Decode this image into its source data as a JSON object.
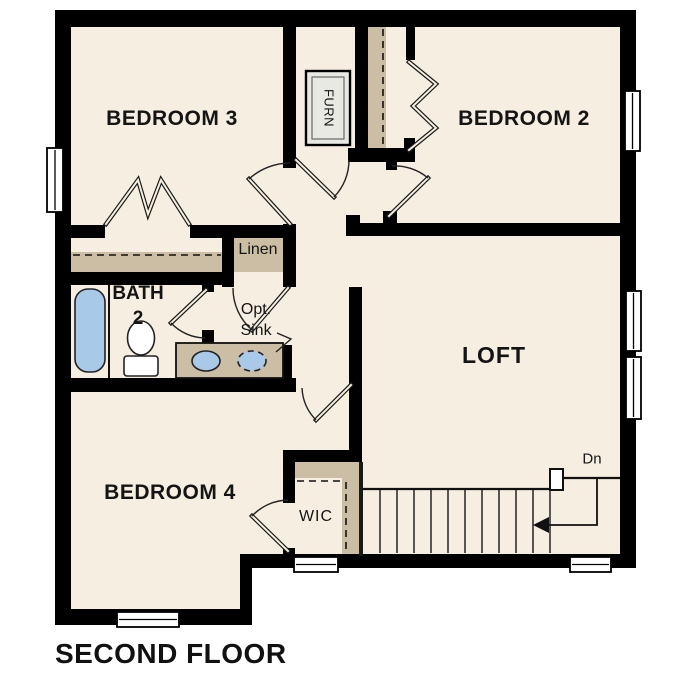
{
  "title": "SECOND FLOOR",
  "rooms": {
    "bedroom3": "BEDROOM 3",
    "bedroom2": "BEDROOM 2",
    "loft": "LOFT",
    "bedroom4": "BEDROOM 4",
    "bath": {
      "line1": "BATH",
      "line2": "2"
    }
  },
  "closets": {
    "linen": "Linen",
    "wic": "WIC"
  },
  "labels": {
    "furnace": "FURN",
    "optional_sink": {
      "line1": "Opt.",
      "line2": "Sink"
    },
    "stairs_down": "Dn"
  },
  "colors": {
    "floor": "#F6EFE1",
    "wall": "#000000",
    "shelf_tan": "#CBBEA4",
    "fixture_blue": "#A9C9E8",
    "furnace_gray": "#E9E9E4",
    "window_white": "#FFFFFF"
  }
}
